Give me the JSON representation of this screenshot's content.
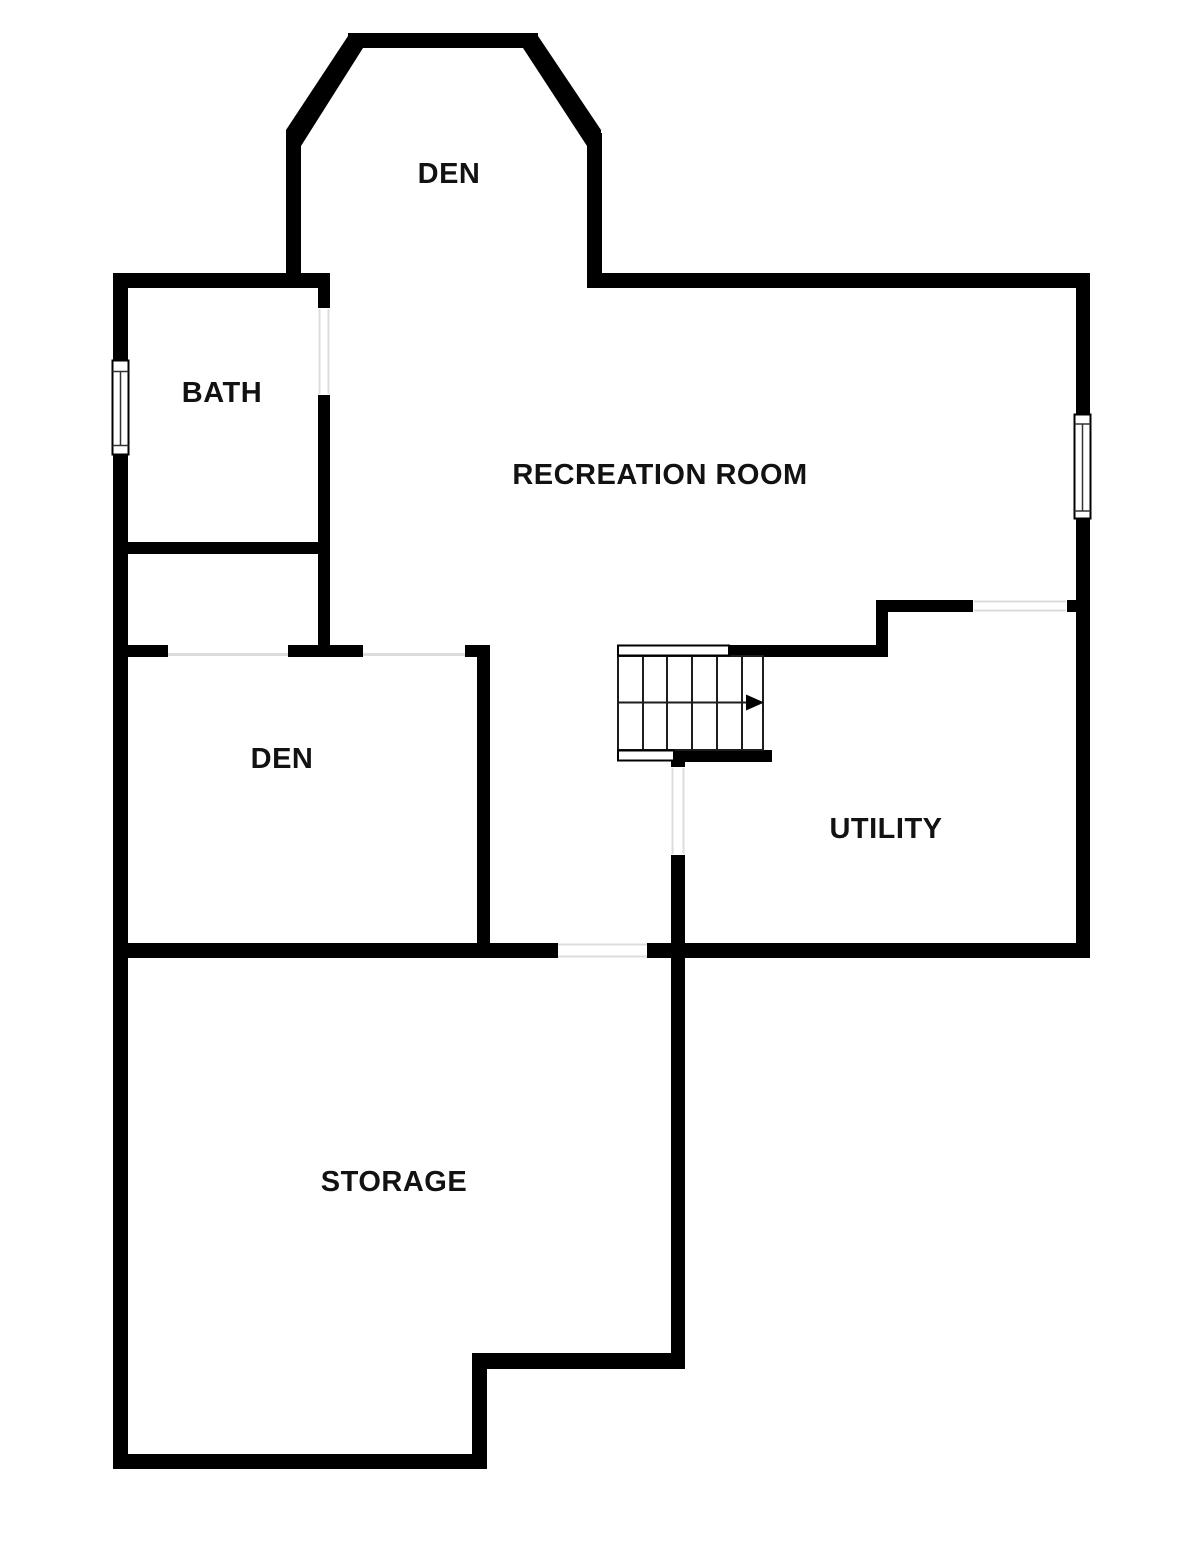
{
  "document": {
    "title": "Floor Plan",
    "canvas": {
      "width": 1200,
      "height": 1551
    }
  },
  "colors": {
    "wall": "#000000",
    "background": "#ffffff",
    "opening_line": "#dcdcdc",
    "stair_line": "#1d1d1d",
    "window_line": "#333333",
    "label_text": "#121212"
  },
  "rooms": [
    {
      "id": "den-top",
      "label": "DEN"
    },
    {
      "id": "bath",
      "label": "BATH"
    },
    {
      "id": "recreation-room",
      "label": "RECREATION ROOM"
    },
    {
      "id": "den-lower",
      "label": "DEN"
    },
    {
      "id": "utility",
      "label": "UTILITY"
    },
    {
      "id": "storage",
      "label": "STORAGE"
    }
  ],
  "stairs": {
    "runs": 2,
    "treads_per_run": 6,
    "direction_arrow": "right"
  },
  "windows": [
    {
      "id": "bath-window",
      "wall": "left-exterior"
    },
    {
      "id": "recreation-window",
      "wall": "right-exterior"
    }
  ],
  "openings": [
    {
      "id": "bath-door"
    },
    {
      "id": "den-lower-opening-left"
    },
    {
      "id": "den-lower-opening-right"
    },
    {
      "id": "utility-top-opening"
    },
    {
      "id": "utility-side-door"
    },
    {
      "id": "storage-door"
    }
  ]
}
